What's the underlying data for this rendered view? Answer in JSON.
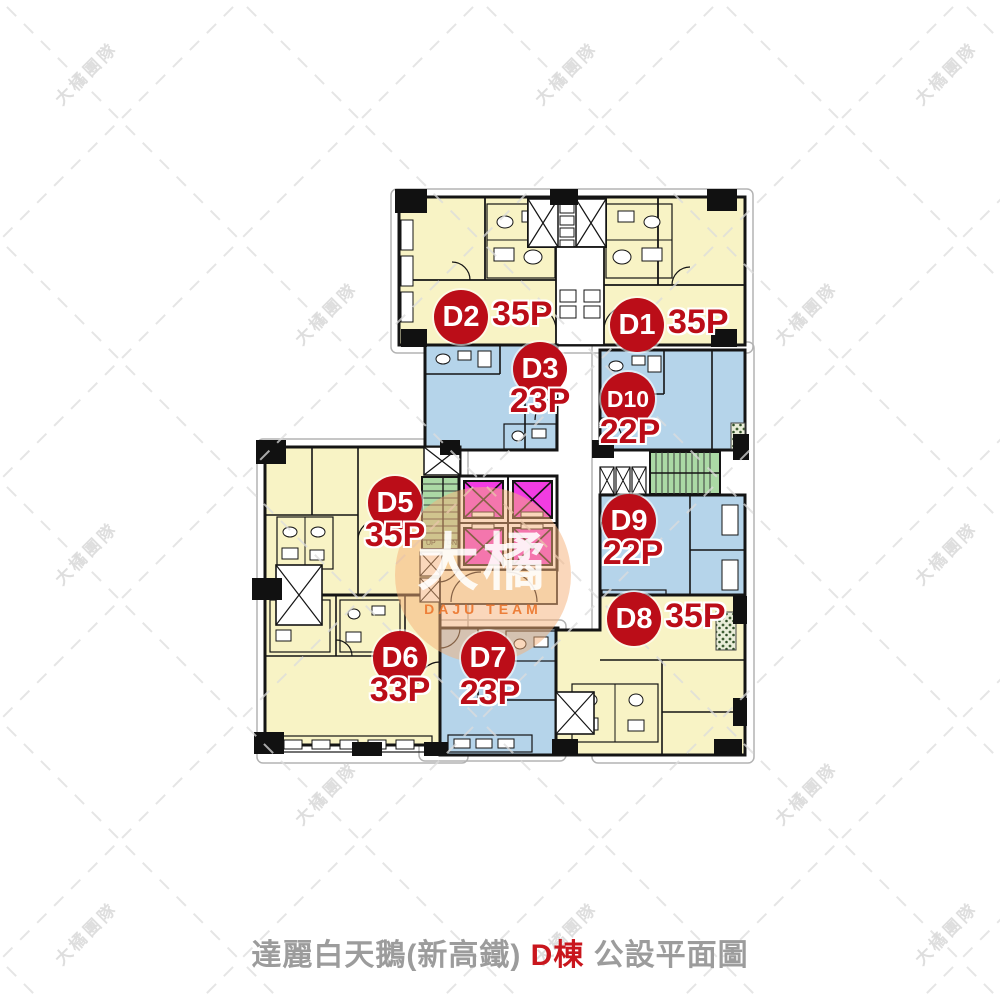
{
  "title": {
    "prefix": "達麗白天鵝(新高鐵) ",
    "building": "D棟",
    "suffix": " 公設平面圖"
  },
  "watermark": {
    "tile_text": "大橘團隊",
    "logo_text": "大橘",
    "logo_subtext": "DAJU TEAM"
  },
  "stairs": {
    "up": "UP",
    "down": "DN"
  },
  "units": [
    {
      "id": "D1",
      "area": "35P",
      "zone_color": "#f8f3c5"
    },
    {
      "id": "D2",
      "area": "35P",
      "zone_color": "#f8f3c5"
    },
    {
      "id": "D3",
      "area": "23P",
      "zone_color": "#b5d4ea"
    },
    {
      "id": "D5",
      "area": "35P",
      "zone_color": "#f8f3c5"
    },
    {
      "id": "D6",
      "area": "33P",
      "zone_color": "#f8f3c5"
    },
    {
      "id": "D7",
      "area": "23P",
      "zone_color": "#b5d4ea"
    },
    {
      "id": "D8",
      "area": "35P",
      "zone_color": "#f8f3c5"
    },
    {
      "id": "D9",
      "area": "22P",
      "zone_color": "#b5d4ea"
    },
    {
      "id": "D10",
      "area": "22P",
      "zone_color": "#b5d4ea"
    }
  ],
  "colors": {
    "unit_yellow": "#f8f3c5",
    "unit_blue": "#b5d4ea",
    "stair_green": "#abd9a5",
    "elevator_magenta": "#f23ce2",
    "badge_red": "#bb0d18",
    "title_gray": "#9c9c9c",
    "title_red": "#c9161d",
    "wall_black": "#141414",
    "watermark_gray": "#d9d9d9",
    "logo_orange": "#f5b078"
  }
}
